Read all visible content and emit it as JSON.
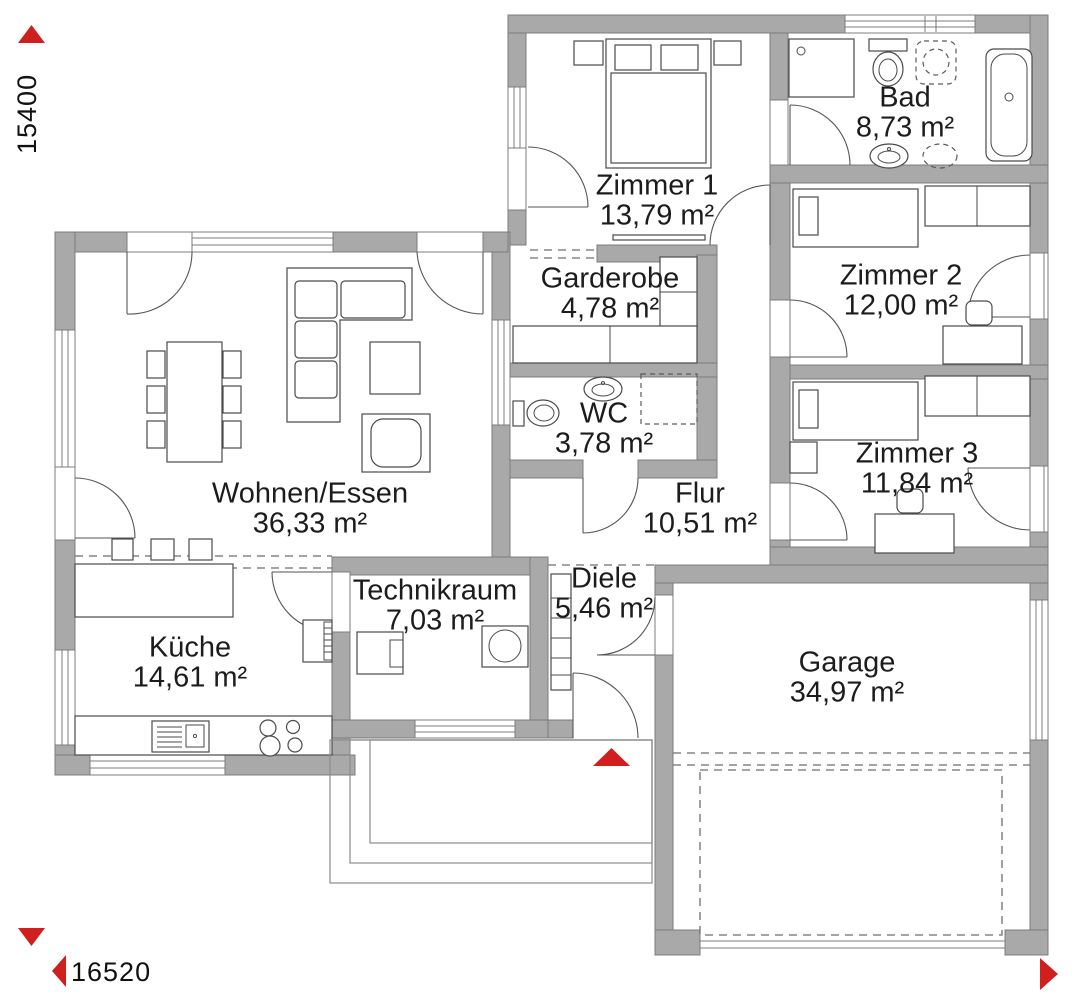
{
  "dimensions": {
    "height_label": "15400",
    "width_label": "16520"
  },
  "rooms": [
    {
      "id": "zimmer1",
      "name": "Zimmer 1",
      "area": "13,79 m²"
    },
    {
      "id": "bad",
      "name": "Bad",
      "area": "8,73 m²"
    },
    {
      "id": "zimmer2",
      "name": "Zimmer 2",
      "area": "12,00 m²"
    },
    {
      "id": "zimmer3",
      "name": "Zimmer 3",
      "area": "11,84 m²"
    },
    {
      "id": "garderobe",
      "name": "Garderobe",
      "area": "4,78 m²"
    },
    {
      "id": "wc",
      "name": "WC",
      "area": "3,78 m²"
    },
    {
      "id": "flur",
      "name": "Flur",
      "area": "10,51 m²"
    },
    {
      "id": "wohnen",
      "name": "Wohnen/Essen",
      "area": "36,33 m²"
    },
    {
      "id": "kueche",
      "name": "Küche",
      "area": "14,61 m²"
    },
    {
      "id": "technikraum",
      "name": "Technikraum",
      "area": "7,03 m²"
    },
    {
      "id": "diele",
      "name": "Diele",
      "area": "5,46 m²"
    },
    {
      "id": "garage",
      "name": "Garage",
      "area": "34,97 m²"
    }
  ],
  "colors": {
    "wall": "#a9a9a9",
    "wall_outline": "#7c7c7c",
    "drawing_line": "#4a4a4a",
    "accent_red": "#cf1f1f",
    "text": "#1c1c1c"
  }
}
